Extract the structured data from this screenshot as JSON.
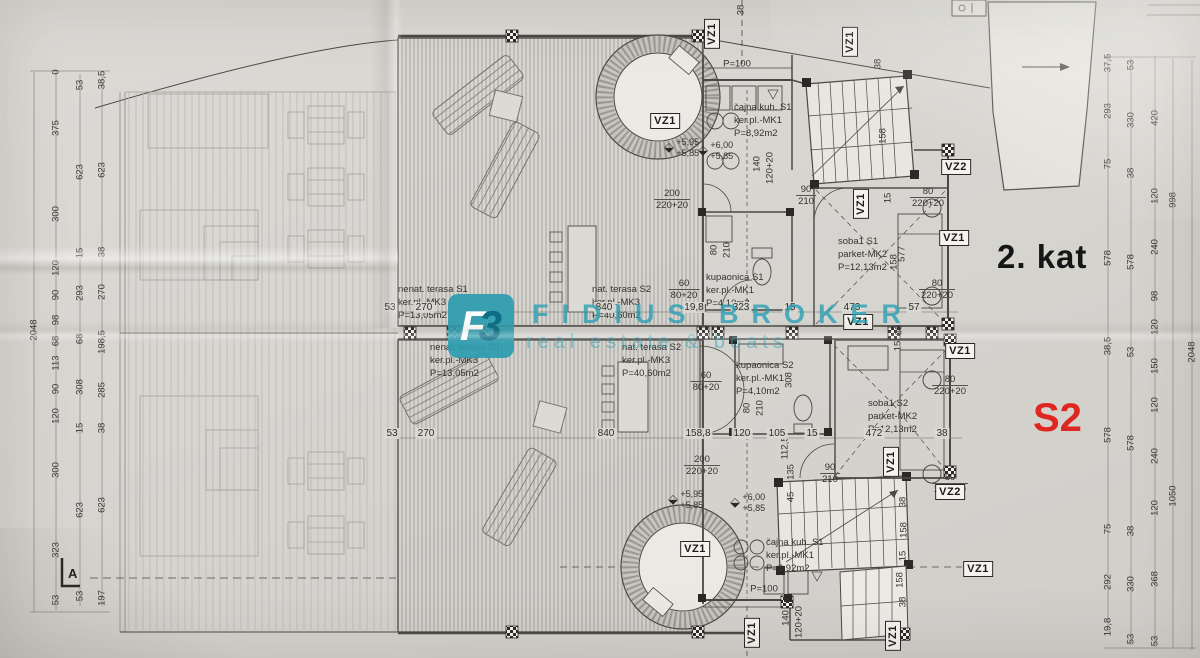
{
  "page": {
    "floor_label": "2. kat",
    "unit_label": "S2",
    "section_label": "A"
  },
  "watermark": {
    "logo_glyph_1": "F",
    "logo_glyph_2": "3",
    "title": "FIDIUS BROKER",
    "subtitle": "real estate & boats",
    "accent_color": "#269db2"
  },
  "colors": {
    "ink": "#35332f",
    "paper": "#d7d5d0",
    "red": "#df2722"
  },
  "rooms": [
    {
      "name": "čajna kuh. S1",
      "finish": "ker.pl.-MK1",
      "area": "P=8,92m2",
      "x": 734,
      "y": 102
    },
    {
      "name": "kupaonica S1",
      "finish": "ker.pl.-MK1",
      "area": "P=4,10m2",
      "x": 706,
      "y": 272
    },
    {
      "name": "soba1 S1",
      "finish": "parket-MK2",
      "area": "P=12,13m2",
      "x": 838,
      "y": 236
    },
    {
      "name": "nenat. terasa S1",
      "finish": "ker.pl.-MK3",
      "area": "P=13,05m2",
      "x": 398,
      "y": 284
    },
    {
      "name": "nat. terasa S2",
      "finish": "ker.pl.-MK3",
      "area": "P=40,60m2",
      "x": 592,
      "y": 284
    },
    {
      "name": "nenat. terasa S2",
      "finish": "ker.pl.-MK3",
      "area": "P=13,05m2",
      "x": 430,
      "y": 342
    },
    {
      "name": "nat. terasa S2",
      "finish": "ker.pl.-MK3",
      "area": "P=40,60m2",
      "x": 622,
      "y": 342
    },
    {
      "name": "kupaonica S2",
      "finish": "ker.pl.-MK1",
      "area": "P=4,10m2",
      "x": 736,
      "y": 360
    },
    {
      "name": "soba1 S2",
      "finish": "parket-MK2",
      "area": "P=12,13m2",
      "x": 868,
      "y": 398
    },
    {
      "name": "čajna kuh. S1",
      "finish": "ker.pl.-MK1",
      "area": "P=8,92m2",
      "x": 766,
      "y": 537
    }
  ],
  "vz_markers": [
    {
      "label": "VZ1",
      "x": 712,
      "y": 34,
      "vertical": true
    },
    {
      "label": "VZ1",
      "x": 850,
      "y": 42,
      "vertical": true
    },
    {
      "label": "VZ1",
      "x": 665,
      "y": 121,
      "vertical": false
    },
    {
      "label": "VZ1",
      "x": 861,
      "y": 204,
      "vertical": true
    },
    {
      "label": "VZ2",
      "x": 956,
      "y": 167,
      "vertical": false
    },
    {
      "label": "VZ1",
      "x": 954,
      "y": 238,
      "vertical": false
    },
    {
      "label": "VZ1",
      "x": 858,
      "y": 322,
      "vertical": false
    },
    {
      "label": "VZ1",
      "x": 960,
      "y": 351,
      "vertical": false
    },
    {
      "label": "VZ1",
      "x": 891,
      "y": 462,
      "vertical": true
    },
    {
      "label": "VZ2",
      "x": 950,
      "y": 492,
      "vertical": false
    },
    {
      "label": "VZ1",
      "x": 978,
      "y": 569,
      "vertical": false
    },
    {
      "label": "VZ1",
      "x": 695,
      "y": 549,
      "vertical": false
    },
    {
      "label": "VZ1",
      "x": 752,
      "y": 633,
      "vertical": true
    },
    {
      "label": "VZ1",
      "x": 893,
      "y": 636,
      "vertical": true
    }
  ],
  "elevation_marks": [
    {
      "upper": "+5,95",
      "lower": "+5,85",
      "x": 682,
      "y": 148
    },
    {
      "upper": "+6,00",
      "lower": "+5,85",
      "x": 716,
      "y": 151
    },
    {
      "upper": "+5,95",
      "lower": "+5,85",
      "x": 686,
      "y": 500
    },
    {
      "upper": "+6,00",
      "lower": "+5,85",
      "x": 748,
      "y": 503
    }
  ],
  "paired_dims": [
    {
      "top": "200",
      "bottom": "220+20",
      "x": 672,
      "y": 188
    },
    {
      "top": "90",
      "bottom": "210",
      "x": 806,
      "y": 184
    },
    {
      "top": "80",
      "bottom": "220+20",
      "x": 928,
      "y": 186
    },
    {
      "top": "80",
      "bottom": "220+20",
      "x": 937,
      "y": 278
    },
    {
      "top": "60",
      "bottom": "80+20",
      "x": 684,
      "y": 278
    },
    {
      "top": "60",
      "bottom": "80+20",
      "x": 706,
      "y": 370
    },
    {
      "top": "80",
      "bottom": "220+20",
      "x": 950,
      "y": 374
    },
    {
      "top": "80",
      "bottom": "220+20",
      "x": 950,
      "y": 472
    },
    {
      "top": "200",
      "bottom": "220+20",
      "x": 702,
      "y": 454
    },
    {
      "top": "90",
      "bottom": "210",
      "x": 830,
      "y": 462
    }
  ],
  "single_dims": [
    {
      "v": "P=100",
      "x": 737,
      "y": 64,
      "rot": false
    },
    {
      "v": "P=100",
      "x": 764,
      "y": 589,
      "rot": false
    },
    {
      "v": "140",
      "x": 757,
      "y": 164,
      "rot": true
    },
    {
      "v": "120+20",
      "x": 770,
      "y": 168,
      "rot": true
    },
    {
      "v": "140",
      "x": 786,
      "y": 618,
      "rot": true
    },
    {
      "v": "120+20",
      "x": 799,
      "y": 622,
      "rot": true
    },
    {
      "v": "80",
      "x": 714,
      "y": 250,
      "rot": true
    },
    {
      "v": "210",
      "x": 727,
      "y": 250,
      "rot": true
    },
    {
      "v": "80",
      "x": 747,
      "y": 408,
      "rot": true
    },
    {
      "v": "210",
      "x": 760,
      "y": 408,
      "rot": true
    },
    {
      "v": "38",
      "x": 878,
      "y": 64,
      "rot": true
    },
    {
      "v": "158",
      "x": 883,
      "y": 136,
      "rot": true
    },
    {
      "v": "15",
      "x": 888,
      "y": 198,
      "rot": true
    },
    {
      "v": "158",
      "x": 894,
      "y": 262,
      "rot": true
    },
    {
      "v": "38",
      "x": 899,
      "y": 330,
      "rot": true
    },
    {
      "v": "15",
      "x": 898,
      "y": 346,
      "rot": true
    },
    {
      "v": "577",
      "x": 902,
      "y": 254,
      "rot": true
    },
    {
      "v": "308",
      "x": 789,
      "y": 380,
      "rot": true
    },
    {
      "v": "112,5",
      "x": 785,
      "y": 448,
      "rot": true
    },
    {
      "v": "135",
      "x": 791,
      "y": 472,
      "rot": true
    },
    {
      "v": "45",
      "x": 791,
      "y": 497,
      "rot": true
    },
    {
      "v": "38",
      "x": 903,
      "y": 502,
      "rot": true
    },
    {
      "v": "158",
      "x": 904,
      "y": 530,
      "rot": true
    },
    {
      "v": "15",
      "x": 903,
      "y": 556,
      "rot": true
    },
    {
      "v": "158",
      "x": 900,
      "y": 580,
      "rot": true
    },
    {
      "v": "38",
      "x": 903,
      "y": 602,
      "rot": true
    },
    {
      "v": "38",
      "x": 741,
      "y": 10,
      "rot": true
    }
  ],
  "dim_rows": {
    "s1_y": 302,
    "s1": [
      {
        "v": "53",
        "x": 390
      },
      {
        "v": "270",
        "x": 424
      },
      {
        "v": "840",
        "x": 604
      },
      {
        "v": "19,8",
        "x": 694
      },
      {
        "v": "323",
        "x": 741
      },
      {
        "v": "15",
        "x": 790
      },
      {
        "v": "473",
        "x": 852
      },
      {
        "v": "57",
        "x": 914
      }
    ],
    "s2_y": 428,
    "s2": [
      {
        "v": "53",
        "x": 392
      },
      {
        "v": "270",
        "x": 426
      },
      {
        "v": "840",
        "x": 606
      },
      {
        "v": "158,8",
        "x": 698
      },
      {
        "v": "120",
        "x": 742
      },
      {
        "v": "105",
        "x": 777
      },
      {
        "v": "15",
        "x": 812
      },
      {
        "v": "472",
        "x": 874
      },
      {
        "v": "38",
        "x": 942
      }
    ]
  },
  "left_chains": [
    {
      "x": 34,
      "items": [
        {
          "v": "2048",
          "y": 330
        }
      ]
    },
    {
      "x": 56,
      "items": [
        {
          "v": "0",
          "y": 72
        },
        {
          "v": "375",
          "y": 128
        },
        {
          "v": "300",
          "y": 214
        },
        {
          "v": "120",
          "y": 268
        },
        {
          "v": "90",
          "y": 295
        },
        {
          "v": "98",
          "y": 320
        },
        {
          "v": "68",
          "y": 341
        },
        {
          "v": "113",
          "y": 363
        },
        {
          "v": "90",
          "y": 389
        },
        {
          "v": "120",
          "y": 416
        },
        {
          "v": "300",
          "y": 470
        },
        {
          "v": "323",
          "y": 550
        },
        {
          "v": "53",
          "y": 600
        }
      ]
    },
    {
      "x": 80,
      "items": [
        {
          "v": "53",
          "y": 85
        },
        {
          "v": "623",
          "y": 172
        },
        {
          "v": "15",
          "y": 253
        },
        {
          "v": "293",
          "y": 293
        },
        {
          "v": "68",
          "y": 339
        },
        {
          "v": "308",
          "y": 387
        },
        {
          "v": "15",
          "y": 428
        },
        {
          "v": "623",
          "y": 510
        },
        {
          "v": "53",
          "y": 596
        }
      ]
    },
    {
      "x": 102,
      "items": [
        {
          "v": "38,5",
          "y": 80
        },
        {
          "v": "623",
          "y": 170
        },
        {
          "v": "38",
          "y": 252
        },
        {
          "v": "270",
          "y": 292
        },
        {
          "v": "198,5",
          "y": 342
        },
        {
          "v": "285",
          "y": 390
        },
        {
          "v": "38",
          "y": 428
        },
        {
          "v": "623",
          "y": 505
        },
        {
          "v": "197",
          "y": 598
        }
      ]
    }
  ],
  "right_chains": [
    {
      "x": 1108,
      "items": [
        {
          "v": "37,5",
          "y": 63
        },
        {
          "v": "293",
          "y": 111
        },
        {
          "v": "75",
          "y": 164
        },
        {
          "v": "578",
          "y": 258
        },
        {
          "v": "38,5",
          "y": 346
        },
        {
          "v": "578",
          "y": 435
        },
        {
          "v": "75",
          "y": 529
        },
        {
          "v": "292",
          "y": 582
        },
        {
          "v": "19,8",
          "y": 627
        }
      ]
    },
    {
      "x": 1131,
      "items": [
        {
          "v": "53",
          "y": 65
        },
        {
          "v": "330",
          "y": 120
        },
        {
          "v": "38",
          "y": 173
        },
        {
          "v": "578",
          "y": 262
        },
        {
          "v": "53",
          "y": 352
        },
        {
          "v": "578",
          "y": 443
        },
        {
          "v": "38",
          "y": 531
        },
        {
          "v": "330",
          "y": 584
        },
        {
          "v": "53",
          "y": 639
        }
      ]
    },
    {
      "x": 1155,
      "items": [
        {
          "v": "420",
          "y": 118
        },
        {
          "v": "120",
          "y": 196
        },
        {
          "v": "240",
          "y": 247
        },
        {
          "v": "98",
          "y": 296
        },
        {
          "v": "120",
          "y": 327
        },
        {
          "v": "150",
          "y": 366
        },
        {
          "v": "120",
          "y": 405
        },
        {
          "v": "240",
          "y": 456
        },
        {
          "v": "120",
          "y": 508
        },
        {
          "v": "368",
          "y": 579
        },
        {
          "v": "53",
          "y": 641
        }
      ]
    },
    {
      "x": 1173,
      "items": [
        {
          "v": "998",
          "y": 200
        },
        {
          "v": "1050",
          "y": 496
        }
      ]
    },
    {
      "x": 1192,
      "items": [
        {
          "v": "2048",
          "y": 352
        }
      ]
    }
  ]
}
